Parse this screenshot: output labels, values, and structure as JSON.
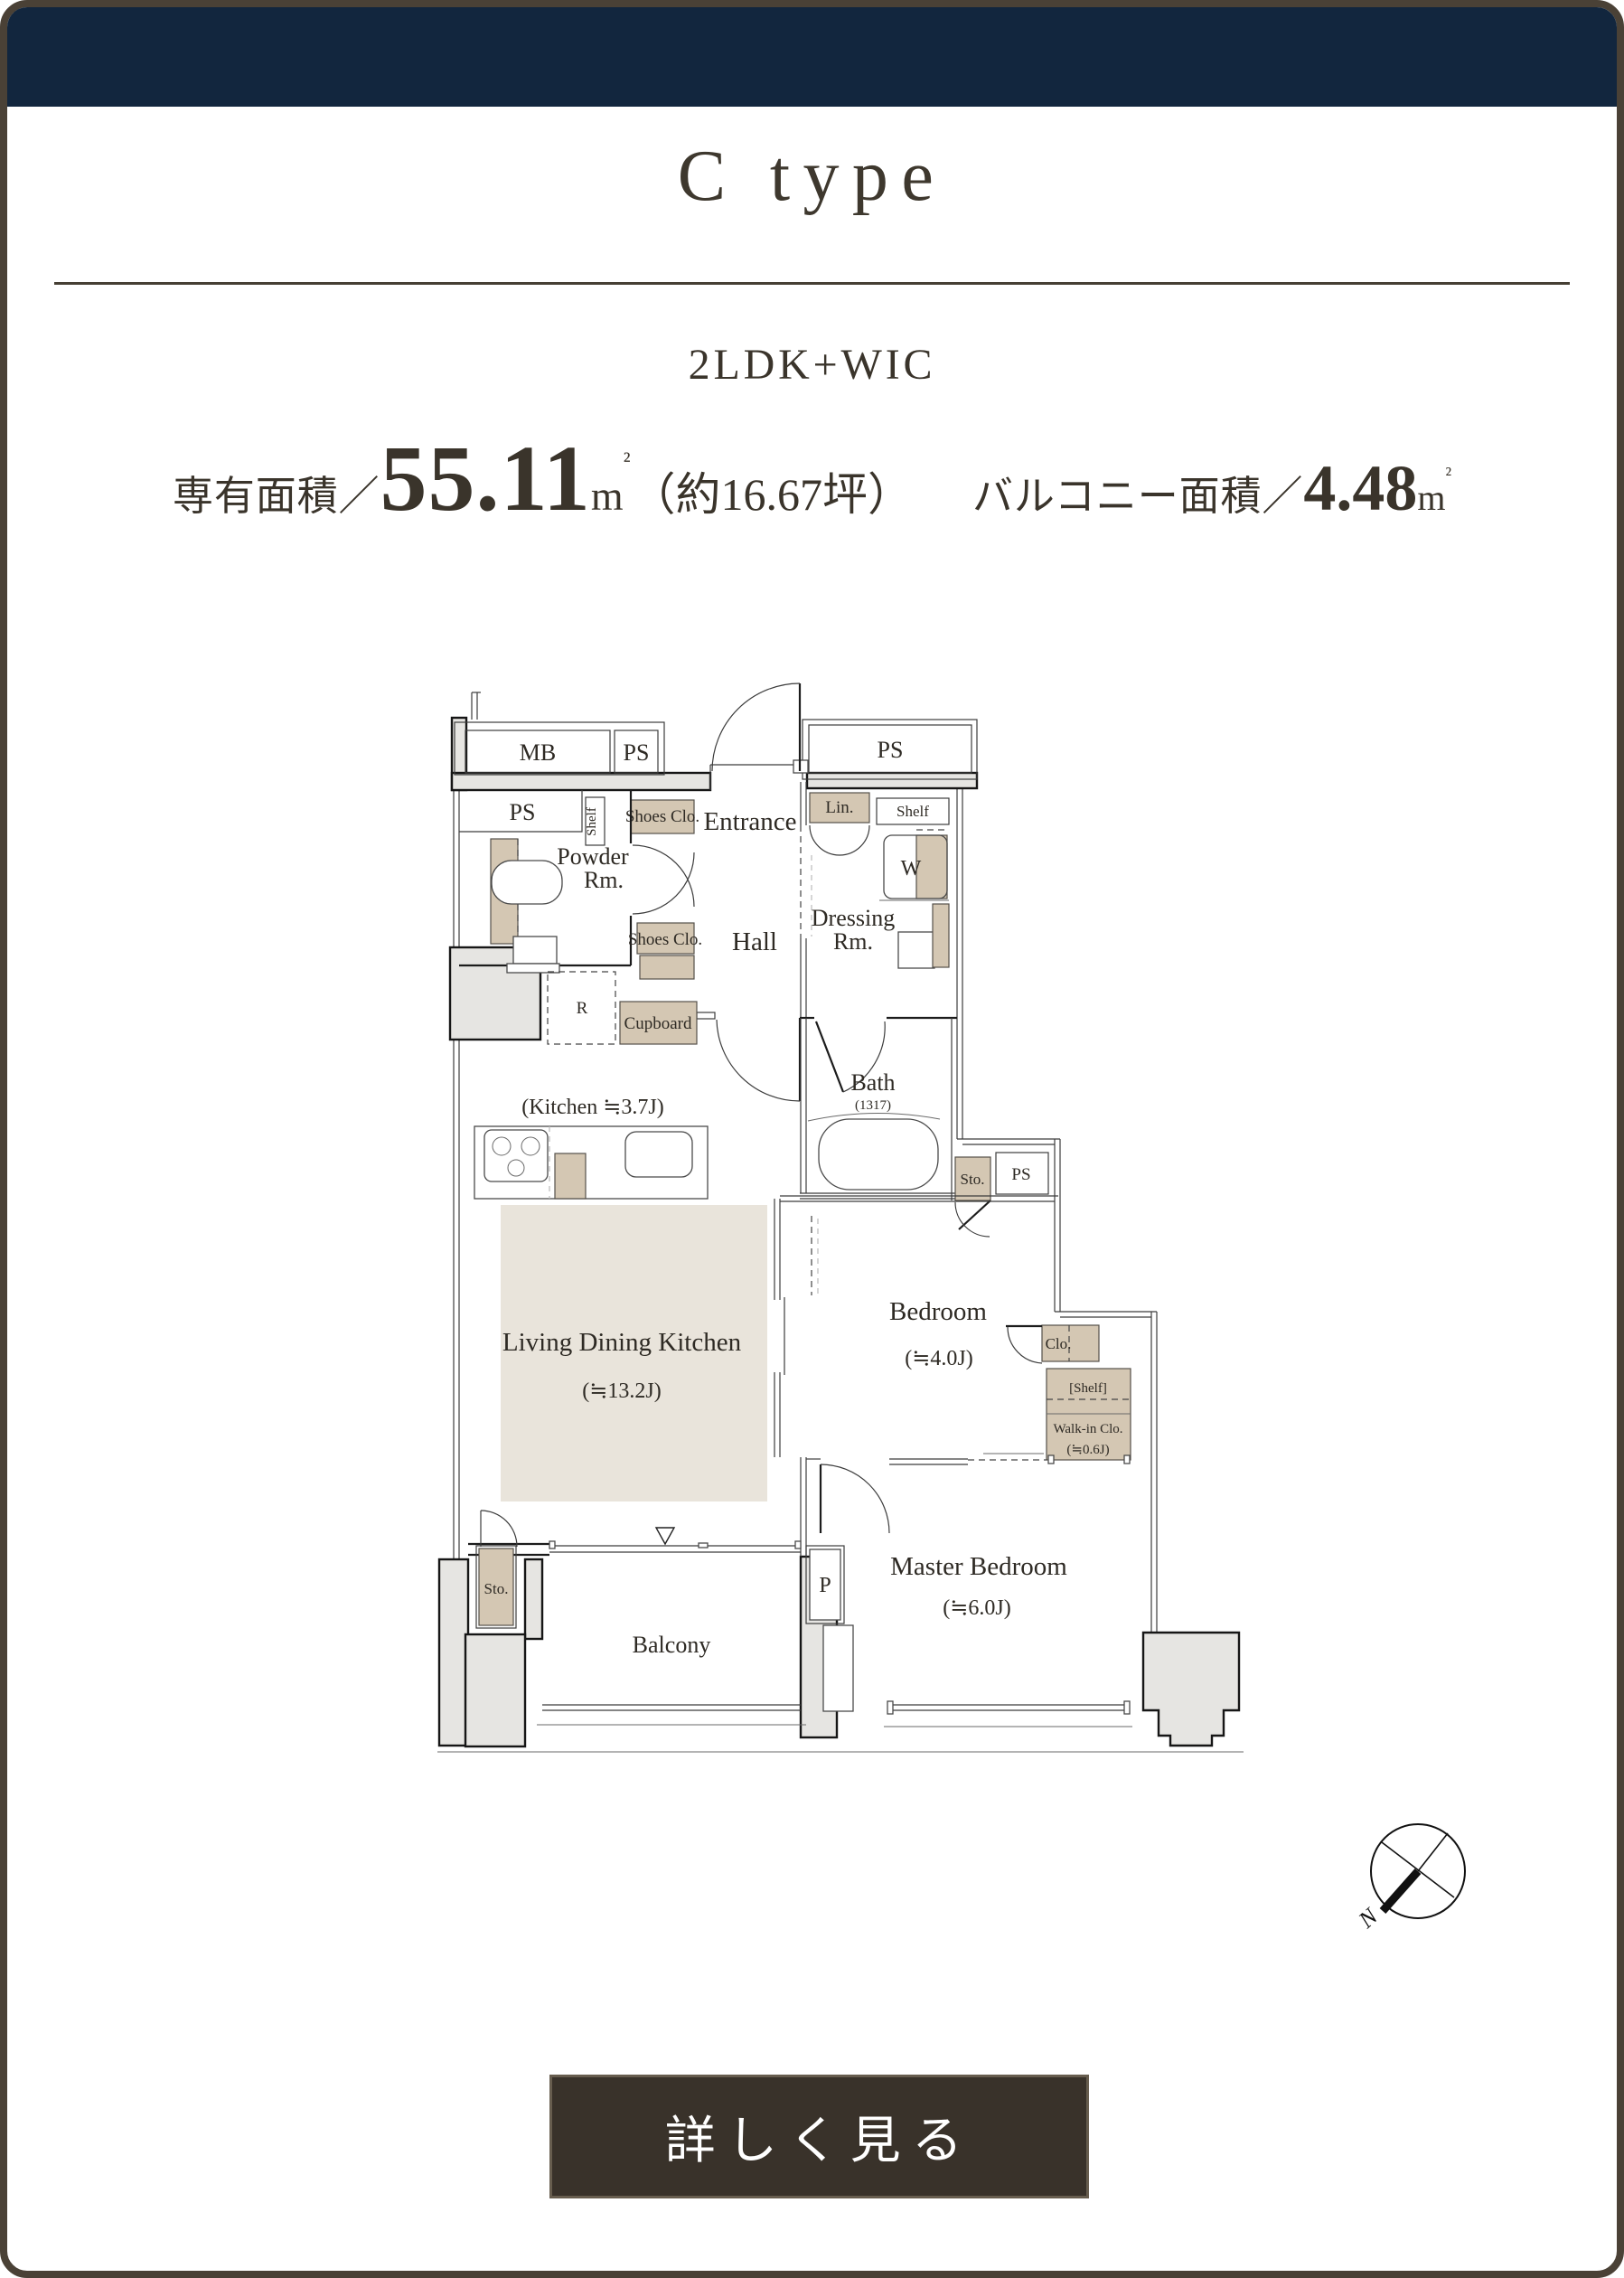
{
  "header": {
    "title": "C type",
    "layout": "2LDK+WIC"
  },
  "area": {
    "exclusive_label": "専有面積／",
    "exclusive_value": "55.11",
    "exclusive_unit_m": "m",
    "exclusive_unit_sq": "²",
    "exclusive_tsubo": "（約16.67坪）",
    "balcony_label": "バルコニー面積／",
    "balcony_value": "4.48",
    "balcony_unit_m": "m",
    "balcony_unit_sq": "²"
  },
  "plan": {
    "labels": {
      "mb": "MB",
      "ps_top": "PS",
      "ps_right": "PS",
      "ps_room": "PS",
      "shelf_v": "Shelf",
      "shoes1": "Shoes Clo.",
      "entrance": "Entrance",
      "lin": "Lin.",
      "shelf2": "Shelf",
      "w": "W",
      "powder1": "Powder",
      "powder2": "Rm.",
      "shoes2": "Shoes Clo.",
      "hall": "Hall",
      "dressing1": "Dressing",
      "dressing2": "Rm.",
      "r": "R",
      "cupboard": "Cupboard",
      "kitchen": "(Kitchen ≒3.7J)",
      "bath": "Bath",
      "bath_size": "(1317)",
      "sto_bath": "Sto.",
      "ps_bath": "PS",
      "ldk1": "Living Dining Kitchen",
      "ldk2": "(≒13.2J)",
      "bed1": "Bedroom",
      "bed2": "(≒4.0J)",
      "clo": "Clo.",
      "shelf3": "[Shelf]",
      "wic1": "Walk-in Clo.",
      "wic2": "(≒0.6J)",
      "master1": "Master Bedroom",
      "master2": "(≒6.0J)",
      "sto_balcony": "Sto.",
      "p": "P",
      "balcony": "Balcony"
    }
  },
  "compass": {
    "north": "N"
  },
  "button": {
    "label": "詳しく見る"
  },
  "colors": {
    "header_navy": "#12263e",
    "frame_brown": "#4a4136",
    "button_brown": "#39322a",
    "fixture_tan": "#d4c7b3",
    "wall_gray": "#e6e5e2",
    "text": "#3a342b"
  }
}
